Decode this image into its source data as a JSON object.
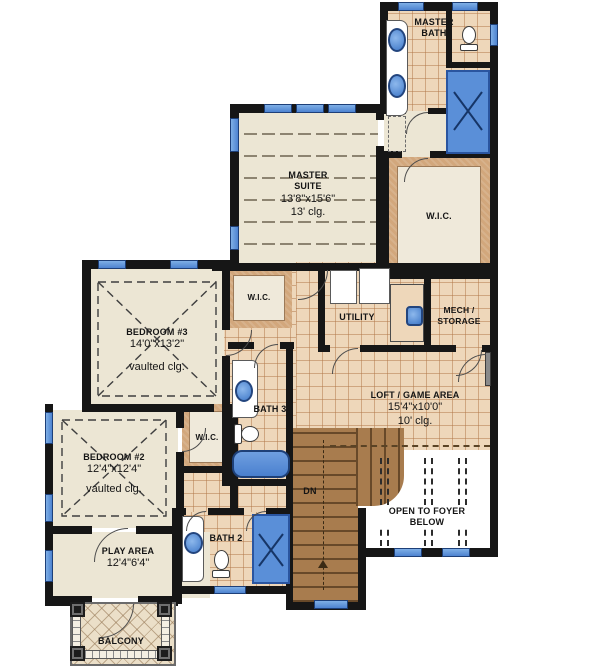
{
  "plan": {
    "type": "floor-plan-second-level",
    "colors": {
      "wall": "#161616",
      "carpet": "#ece6d4",
      "tile": "#eed7ba",
      "closet_shelf": "#d2a77c",
      "stairs": "#a87c4e",
      "fixture_blue": "#5a8fd8",
      "window_blue": "#4d83d0",
      "lattice": "#ebdfc8",
      "label_text": "#151515"
    },
    "rooms": {
      "master_bath": {
        "name": "MASTER\nBATH"
      },
      "master_suite": {
        "name": "MASTER\nSUITE",
        "dims": "13'8\"x15'6\"",
        "ceiling": "13' clg."
      },
      "wic_master": {
        "name": "W.I.C."
      },
      "wic_hall": {
        "name": "W.I.C."
      },
      "bedroom3": {
        "name": "BEDROOM #3",
        "dims": "14'0\"x13'2\"",
        "ceiling": "vaulted clg."
      },
      "utility": {
        "name": "UTILITY"
      },
      "mech_storage": {
        "name": "MECH /\nSTORAGE"
      },
      "bath3": {
        "name": "BATH 3"
      },
      "wic_bedroom2": {
        "name": "W.I.C."
      },
      "bedroom2": {
        "name": "BEDROOM #2",
        "dims": "12'4\"x12'4\"",
        "ceiling": "vaulted clg."
      },
      "loft": {
        "name": "LOFT / GAME AREA",
        "dims": "15'4\"x10'0\"",
        "ceiling": "10' clg."
      },
      "play_area": {
        "name": "PLAY AREA",
        "dims": "12'4\"6'4\""
      },
      "bath2": {
        "name": "BATH 2"
      },
      "balcony": {
        "name": "BALCONY"
      }
    },
    "annotations": {
      "stairs_down": "DN",
      "open_to_foyer": "OPEN TO FOYER\nBELOW"
    }
  }
}
